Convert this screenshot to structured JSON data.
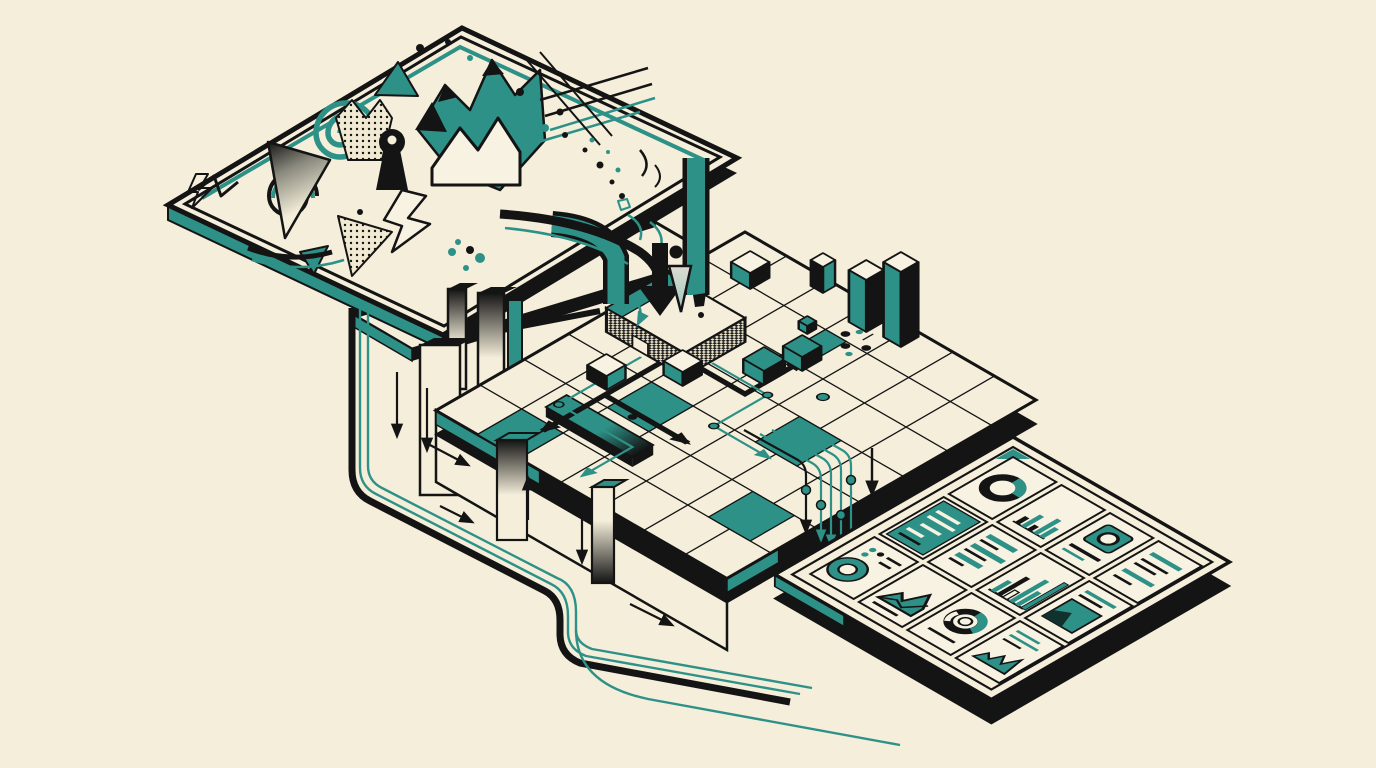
{
  "scene": {
    "description": "Isometric illustration of chaotic abstract shapes being funneled through a processing grid pipeline into an organized analytics dashboard",
    "style": "memphis-isometric-illustration",
    "background_color": "#f4eeda",
    "palette": {
      "cream": "#f4eeda",
      "paper": "#f7f2e2",
      "teal": "#2e9187",
      "teal_light": "#6fbcae",
      "ink": "#141414"
    }
  },
  "stages": [
    {
      "id": "chaos-panel",
      "role": "unstructured-input",
      "shapes": [
        "teal-spiral",
        "ink-swirl",
        "gradient-triangle",
        "halftone-triangle",
        "halftone-zigzag-ribbon",
        "teal-mountain-zigzag",
        "outlined-peaks",
        "lightning-bolt",
        "keyhole-figure",
        "white-bolt",
        "teal-triangles",
        "ink-triangles",
        "scatter-dots",
        "speed-lines",
        "curved-swoosh",
        "squiggles"
      ]
    },
    {
      "id": "processing-grid",
      "role": "transformation-pipeline",
      "objects": [
        "upper-platform",
        "pillars",
        "entry-pedestal",
        "flow-chute",
        "drop-arrow",
        "halftone-cone",
        "grid-platform",
        "teal-cells",
        "data-cubes",
        "tall-bar-columns",
        "gradient-plank",
        "routing-arrows",
        "circuit-traces",
        "trace-nodes",
        "loop-pipe",
        "flow-arrows",
        "gradient-slabs"
      ]
    },
    {
      "id": "dashboard-panel",
      "role": "structured-output",
      "tiles": [
        {
          "id": "donut-ring",
          "type": "donut",
          "segments": [
            70,
            30
          ]
        },
        {
          "id": "column-chart-small",
          "type": "bar",
          "values": [
            12,
            22,
            9,
            28,
            18
          ]
        },
        {
          "id": "icon-badge",
          "type": "badge"
        },
        {
          "id": "text-lines",
          "type": "text"
        },
        {
          "id": "highlight-card",
          "type": "text-inverse"
        },
        {
          "id": "row-bars",
          "type": "hbar",
          "values": [
            32,
            20,
            36,
            24,
            28,
            16
          ]
        },
        {
          "id": "column-chart-large",
          "type": "bar",
          "values": [
            20,
            34,
            14,
            42,
            26,
            50
          ]
        },
        {
          "id": "media-card",
          "type": "image-text"
        },
        {
          "id": "donut-dotlist",
          "type": "donut-list"
        },
        {
          "id": "area-mountain",
          "type": "area"
        },
        {
          "id": "gauge-donut",
          "type": "gauge"
        },
        {
          "id": "sparkline-area",
          "type": "area-small"
        }
      ]
    }
  ],
  "connections": [
    {
      "from": "chaos-panel",
      "to": "processing-grid",
      "via": "flow-chute",
      "style": "curved-arrow-and-teal-bands"
    },
    {
      "from": "chaos-panel",
      "to": "processing-grid",
      "via": "loop-pipe",
      "style": "rounded-black-pipe-with-teal-traces"
    },
    {
      "from": "processing-grid",
      "to": "dashboard-panel",
      "via": "trace-bundle",
      "style": "teal-circuit-traces-with-nodes"
    }
  ]
}
